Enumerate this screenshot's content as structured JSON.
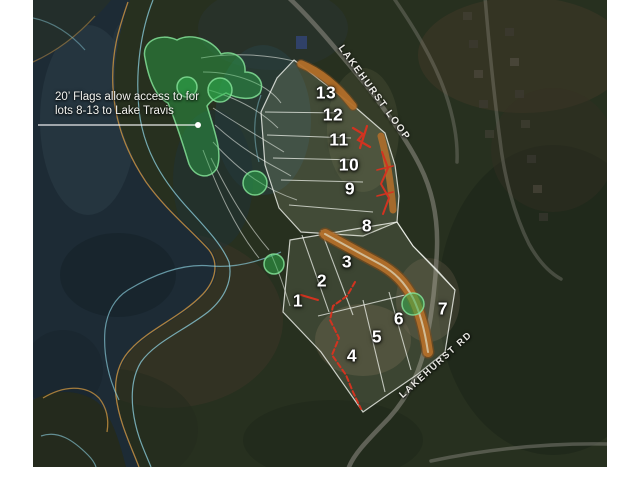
{
  "map": {
    "type": "aerial-lot-map",
    "annotation": {
      "line1": "20’ Flags allow access to for",
      "line2": "lots 8-13 to Lake Travis"
    },
    "roads": {
      "loop": "LAKEHURST LOOP",
      "rd": "LAKEHURST RD"
    },
    "lots": [
      {
        "label": "1"
      },
      {
        "label": "2"
      },
      {
        "label": "3"
      },
      {
        "label": "4"
      },
      {
        "label": "5"
      },
      {
        "label": "6"
      },
      {
        "label": "7"
      },
      {
        "label": "8"
      },
      {
        "label": "9"
      },
      {
        "label": "10"
      },
      {
        "label": "11"
      },
      {
        "label": "12"
      },
      {
        "label": "13"
      }
    ],
    "colors": {
      "flag_access_green": "#2eb34d",
      "lot_boundary_white": "#f2f5ef",
      "creek_orange": "#b5702a",
      "contour_cyan": "#8ed2e2",
      "shoreline_orange": "#c69140",
      "survey_mark_red": "#d23320",
      "water_dark": "#1d2b35",
      "land_green": "#27301f"
    }
  }
}
